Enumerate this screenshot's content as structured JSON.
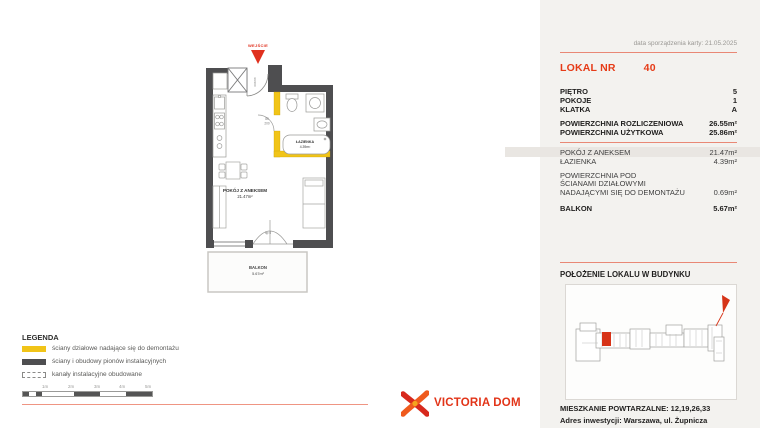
{
  "colors": {
    "accent_red": "#e63b17",
    "separator_red": "#e98875",
    "wall_dark": "#4e4e50",
    "partition_yellow": "#f1c418",
    "panel_bg": "#f3f2ef",
    "highlight_stripe": "#e9e6e2",
    "unit_marker_red": "#d73318"
  },
  "header": {
    "brand_top": "METRO",
    "brand_script": "art",
    "brand_fragment": "13",
    "date_line": "data sporządzenia karty: 21.05.2025",
    "unit_label": "LOKAL NR",
    "unit_number": "40"
  },
  "details": {
    "floor_rows": [
      {
        "label": "PIĘTRO",
        "value": "5"
      },
      {
        "label": "POKOJE",
        "value": "1"
      },
      {
        "label": "KLATKA",
        "value": "A"
      }
    ],
    "area_rows": [
      {
        "label": "POWIERZCHNIA ROZLICZENIOWA",
        "value": "26.55m²"
      },
      {
        "label": "POWIERZCHNIA UŻYTKOWA",
        "value": "25.86m²"
      }
    ],
    "room_rows": [
      {
        "label": "POKÓJ Z ANEKSEM",
        "value": "21.47m²"
      },
      {
        "label": "ŁAZIENKA",
        "value": "4.39m²"
      }
    ],
    "demountable": {
      "label_lines": [
        "POWIERZCHNIA POD",
        "ŚCIANAMI DZIAŁOWYMI",
        "NADAJĄCYMI SIĘ DO DEMONTAŻU"
      ],
      "value": "0.69m²"
    },
    "balcony_row": {
      "label": "BALKON",
      "value": "5.67m²"
    }
  },
  "location": {
    "title": "POŁOŻENIE LOKALU W BUDYNKU",
    "repeat_line": "MIESZKANIE POWTARZALNE: 12,19,26,33",
    "address_line": "Adres inwestycji: Warszawa, ul. Żupnicza"
  },
  "plan": {
    "entrance_label": "WEJŚCIE",
    "room_label": "POKÓJ Z ANEKSEM",
    "room_area": "21.47m²",
    "bath_label": "ŁAZIENKA",
    "bath_area": "4.39m²",
    "balcony_label": "BALKON",
    "balcony_area": "5.67m²",
    "bath_door_w": "80",
    "bath_door_h": "200",
    "entry_door_dim": "90/200",
    "balcony_door_dim": "90/230",
    "sill_label": "hp 0"
  },
  "legend": {
    "title": "LEGENDA",
    "items": [
      {
        "swatch": "yellow-wall",
        "label": "ściany działowe nadające się do demontażu"
      },
      {
        "swatch": "dark-wall",
        "label": "ściany i obudowy pionów instalacyjnych"
      },
      {
        "swatch": "dashed-duct",
        "label": "kanały instalacyjne obudowane"
      }
    ],
    "scale_labels": [
      "1m",
      "2m",
      "3m",
      "4m",
      "5m"
    ]
  },
  "footer": {
    "brand": "VICTORIA DOM"
  }
}
